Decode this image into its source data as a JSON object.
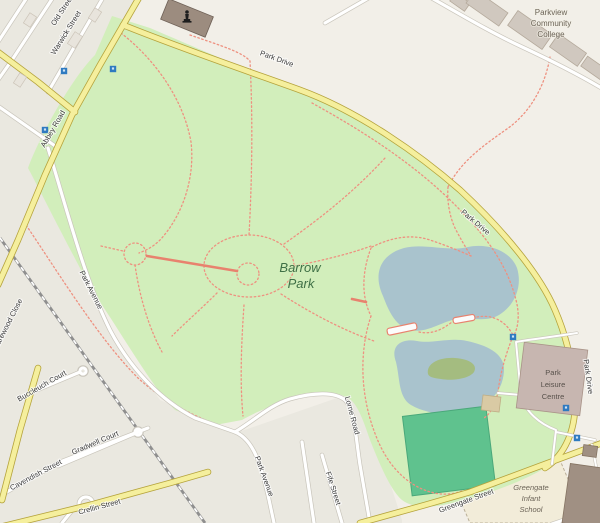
{
  "map": {
    "style": "openstreetmap",
    "park": {
      "name": "Barrow Park",
      "line1": "Barrow",
      "line2": "Park"
    },
    "roads": {
      "old_street": "Old Street",
      "warwick_street": "Warwick Street",
      "abbey_road": "Abbey Road",
      "park_drive": "Park Drive",
      "park_avenue": "Park Avenue",
      "lorne_road": "Lorne Road",
      "fife_street": "Fife Street",
      "cavendish_street": "Cavendish Street",
      "buccleuch_court": "Buccleuch Court",
      "gradwell_court": "Gradwell Court",
      "harewood_close": "Harewood Close",
      "crellin_street": "Crellin Street",
      "greengate_street": "Greengate Street"
    },
    "places": {
      "college": {
        "line1": "Parkview",
        "line2": "Community",
        "line3": "College"
      },
      "leisure": {
        "line1": "Park",
        "line2": "Leisure",
        "line3": "Centre"
      },
      "school": {
        "line1": "Greengate",
        "line2": "Infant",
        "line3": "School"
      }
    },
    "icons": {
      "monument": "statue-monument",
      "marker": "blue-square-marker",
      "bridge": "footbridge"
    },
    "colors": {
      "base": "#f2efe8",
      "residential": "#eae8e0",
      "park": "#d2eebb",
      "lake": "#a9c3cd",
      "island": "#a4bc80",
      "pitch": "#5fc28e",
      "pitch_edge": "#4aa87a",
      "road_yellow": "#f5ef9d",
      "road_yellow_casing": "#b5a33c",
      "road_white": "#ffffff",
      "road_casing": "#c9c5bb",
      "railway": "#8f8f8f",
      "path": "#ee9180",
      "path_solid": "#e8826e",
      "building": "#d0c8bf",
      "building_outline": "#b4a99b",
      "monument_bldg": "#9c8c7f",
      "leisure_bldg": "#c7b6b0",
      "dark_bldg": "#a09083",
      "marker_blue": "#2e7ac0",
      "label_dark": "#3a3a3a",
      "park_label": "#3f7046",
      "place_label": "#6c6458",
      "school_plot": "#f2ecd9"
    }
  }
}
